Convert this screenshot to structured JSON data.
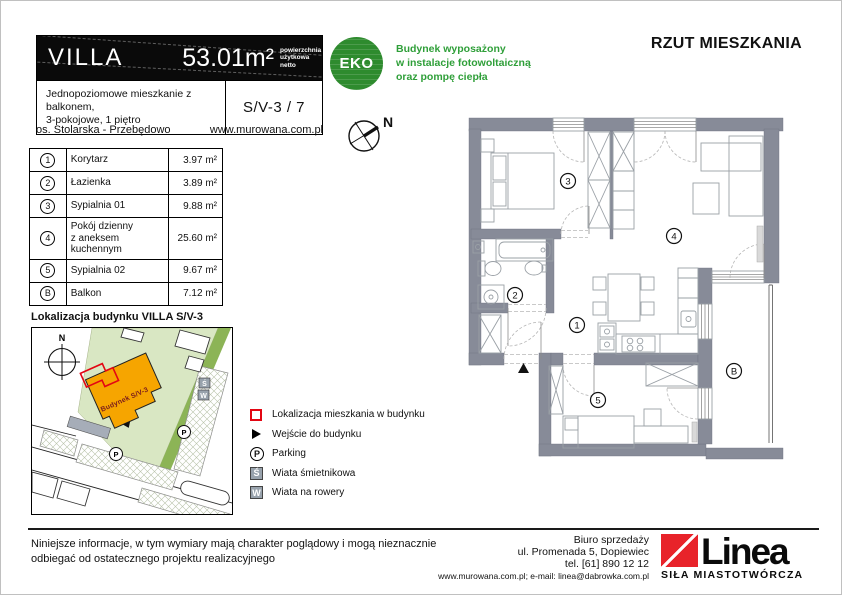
{
  "page": {
    "plan_title": "RZUT MIESZKANIA"
  },
  "header": {
    "title": "VILLA",
    "area": "53.01m²",
    "area_note": "powierzchnia\nużytkowa\nnetto",
    "description": "Jednopoziomowe mieszkanie z balkonem,\n3-pokojowe, 1 piętro",
    "unit_code": "S/V-3 / 7",
    "location": "os. Stolarska - Przebędowo",
    "website": "www.murowana.com.pl"
  },
  "eco": {
    "badge": "EKO",
    "text": "Budynek wyposażony\nw instalacje fotowoltaiczną\noraz pompę ciepła"
  },
  "compass": {
    "label": "N"
  },
  "rooms": [
    {
      "id": "1",
      "name": "Korytarz",
      "area": "3.97 m²"
    },
    {
      "id": "2",
      "name": "Łazienka",
      "area": "3.89 m²"
    },
    {
      "id": "3",
      "name": "Sypialnia 01",
      "area": "9.88 m²"
    },
    {
      "id": "4",
      "name": "Pokój dzienny\nz aneksem kuchennym",
      "area": "25.60 m²"
    },
    {
      "id": "5",
      "name": "Sypialnia 02",
      "area": "9.67 m²"
    },
    {
      "id": "B",
      "name": "Balkon",
      "area": "7.12 m²"
    }
  ],
  "site_map": {
    "title": "Lokalizacja budynku  VILLA S/V-3",
    "building_label": "Budynek S/V-3",
    "compass_label": "N",
    "parking_label": "P",
    "trash_label": "Ś",
    "bike_label": "W"
  },
  "legend": [
    {
      "label": "Lokalizacja mieszkania w budynku"
    },
    {
      "label": "Wejście do budynku"
    },
    {
      "label": "Parking"
    },
    {
      "label": "Wiata śmietnikowa"
    },
    {
      "label": "Wiata na rowery"
    }
  ],
  "footer": {
    "disclaimer": "Niniejsze informacje, w tym wymiary mają charakter poglądowy i mogą nieznacznie\nodbiegać od ostatecznego projektu realizacyjnego",
    "office": "Biuro sprzedaży\nul. Promenada 5, Dopiewiec\ntel. [61] 890 12 12",
    "contact_line": "www.murowana.com.pl;  e-mail: linea@dabrowka.com.pl",
    "logo_text": "Linea",
    "logo_tagline": "SIŁA MIASTOTWÓRCZA"
  },
  "colors": {
    "eco_green": "#2e8b2e",
    "accent_red": "#e30613",
    "wall_gray": "#878b98",
    "site_green_light": "#d9e7c3",
    "site_green_dark": "#8cb456",
    "building_orange": "#f6a500"
  }
}
